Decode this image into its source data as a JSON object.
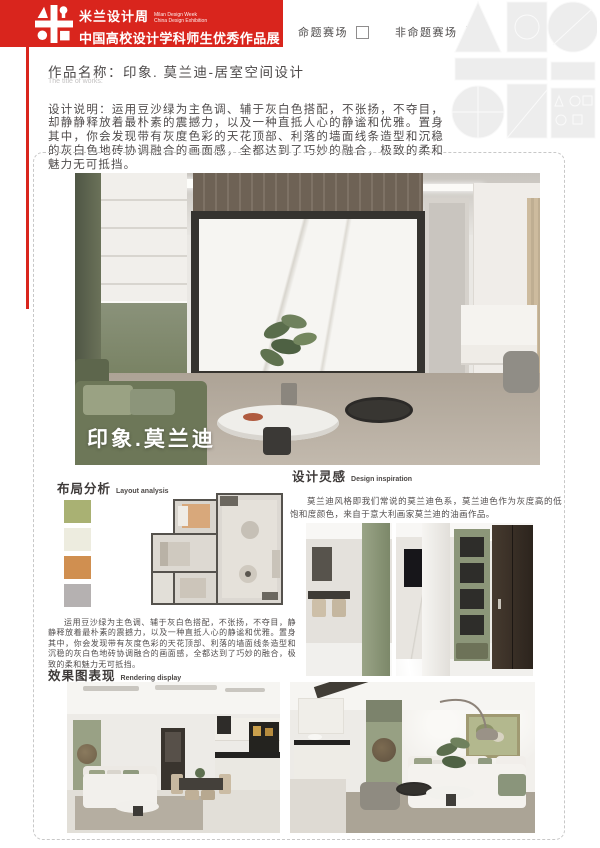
{
  "colors": {
    "brand_red": "#d9251d",
    "heading_text": "#3e3a39",
    "body_text": "#534f4f"
  },
  "header": {
    "logo": "milan-design-week-logo",
    "cn1": "米兰设计周",
    "en1": "Milan Design Week",
    "en2": "China Design Exhibition",
    "cn2": "中国高校设计学科师生优秀作品展"
  },
  "entry": {
    "checkmark": "✔",
    "options": [
      {
        "label": "命题赛场",
        "checked": false
      },
      {
        "label": "非命题赛场",
        "checked": true
      }
    ]
  },
  "work": {
    "title_label": "作品名称：",
    "title": "印象. 莫兰迪-居室空间设计",
    "title_en": "The title of works:",
    "desc_label": "设计说明：",
    "description": "运用豆沙绿为主色调、辅于灰白色搭配，不张扬，不夺目，却静静释放着最朴素的震撼力，以及一种直抵人心的静谧和优雅。置身其中，你会发现带有灰度色彩的天花顶部、利落的墙面线条造型和沉稳的灰白色地砖协调融合的画面感，全都达到了巧妙的融合，极致的柔和魅力无可抵挡。"
  },
  "main_image": {
    "caption": "印象.莫兰迪"
  },
  "sections": {
    "layout": {
      "cn": "布局分析",
      "en": "Layout analysis",
      "swatches": [
        "#a9b173",
        "#edecdf",
        "#d08f50",
        "#b5b1b1"
      ]
    },
    "inspiration": {
      "cn": "设计灵感",
      "en": "Design inspiration",
      "text": "莫兰迪风格即我们常说的莫兰迪色系，莫兰迪色作为灰度高的低饱和度颜色，来自于意大利画家莫兰迪的油画作品。"
    },
    "body_text": "运用豆沙绿为主色调、辅于灰白色搭配，不张扬，不夺目，静静释放着最朴素的震撼力，以及一种直抵人心的静谧和优雅。置身其中，你会发现带有灰度色彩的天花顶部、利落的墙面线条造型和沉稳的灰白色地砖协调融合的画面感，全都达到了巧妙的融合，极致的柔和魅力无可抵挡。",
    "rendering": {
      "cn": "效果图表现",
      "en": "Rendering display"
    }
  }
}
